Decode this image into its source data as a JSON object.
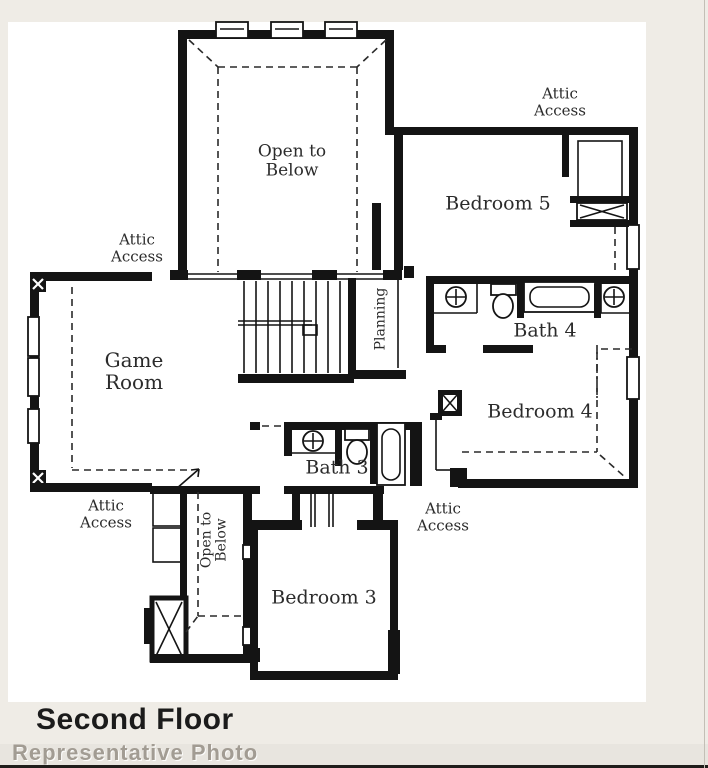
{
  "footer": {
    "title": "Second Floor",
    "watermark": "Representative Photo"
  },
  "labels": {
    "attic_access_top_left": "Attic\nAccess",
    "open_to_below_top": "Open to\nBelow",
    "attic_access_top_right": "Attic\nAccess",
    "bedroom5": "Bedroom 5",
    "bath4": "Bath 4",
    "planning": "Planning",
    "game_room": "Game\nRoom",
    "bedroom4": "Bedroom 4",
    "bath3": "Bath 3",
    "attic_access_right": "Attic\nAccess",
    "attic_access_bottom_left": "Attic\nAccess",
    "open_to_below_strip": "Open to\nBelow",
    "bedroom3": "Bedroom 3"
  },
  "colors": {
    "wall": "#141414",
    "paper": "#ffffff",
    "page_background": "#efece6",
    "label_text": "#2b2b2b",
    "watermark_text": "#a29c93"
  }
}
